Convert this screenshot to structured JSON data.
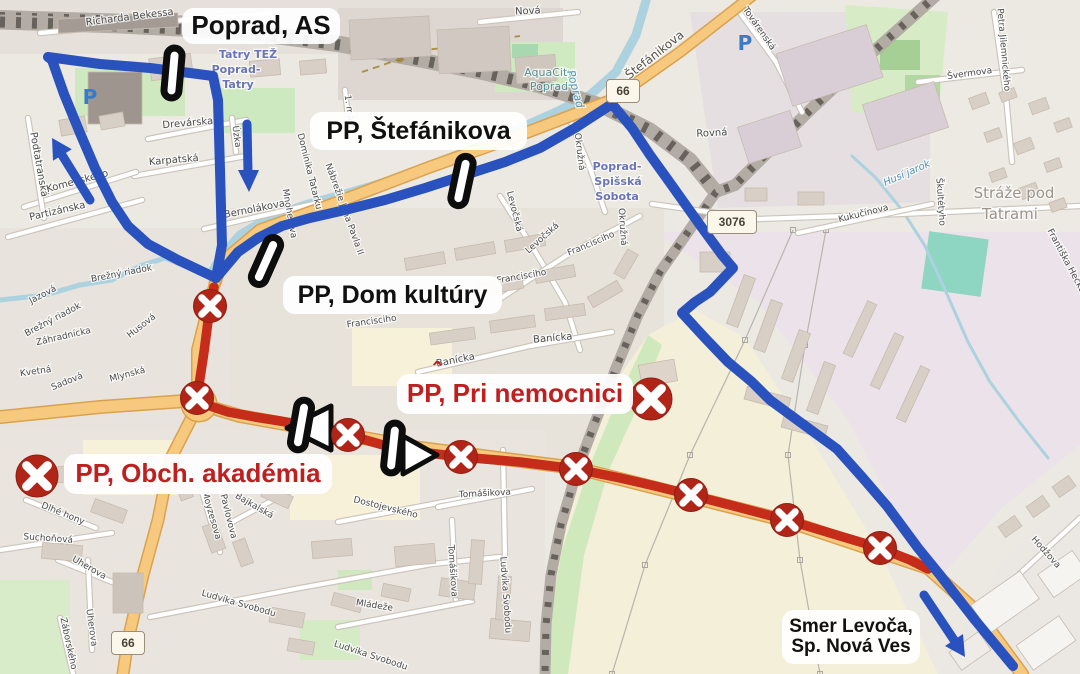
{
  "title": "Poprad bus detour map",
  "colors": {
    "route_blue": "#2a52be",
    "route_red": "#c52c19",
    "closed_x_fill": "#b02518",
    "label_text_red": "#c01f1f",
    "label_text_black": "#111111",
    "label_bg": "#ffffff",
    "stop_marker_fill": "#ffffff",
    "stop_marker_border": "#0d0d0d",
    "water": "#abd2de",
    "orange_road": "#f6c97e",
    "orange_casing": "#daa24f",
    "railway_base": "#b3aca4",
    "railway_dash": "#67625c",
    "road_white": "#ffffff",
    "road_casing": "#cbc4bb",
    "building": "#d8cfc6",
    "building_edge": "#c6bbb0",
    "farmland": "#f3efd8",
    "green_area": "#cfe8c0",
    "pitch_teal": "#8fd6c2",
    "parking_blue": "#3a7bc8"
  },
  "stop_labels": [
    {
      "id": "poprad-as",
      "text": "Poprad, AS",
      "text_color": "black"
    },
    {
      "id": "pp-stefanikova",
      "text": "PP, Štefánikova",
      "text_color": "black"
    },
    {
      "id": "pp-dom-kultury",
      "text": "PP, Dom kultúry",
      "text_color": "black"
    },
    {
      "id": "pp-pri-nemocnici",
      "text": "PP, Pri nemocnici",
      "text_color": "red",
      "accent_mark": "ˆ"
    },
    {
      "id": "pp-obch-akademia",
      "text": "PP, Obch. akadémia",
      "text_color": "red"
    },
    {
      "id": "smer-levoca",
      "line1": "Smer Levoča,",
      "line2": "Sp. Nová Ves",
      "text_color": "black"
    }
  ],
  "road_badges": [
    {
      "text": "66",
      "x": 606,
      "y": 79
    },
    {
      "text": "3076",
      "x": 707,
      "y": 210
    },
    {
      "text": "66",
      "x": 111,
      "y": 631
    }
  ],
  "parking_icons": [
    {
      "glyph": "P",
      "x": 90,
      "y": 104
    },
    {
      "glyph": "P",
      "x": 745,
      "y": 50
    }
  ],
  "routes": {
    "detour_loop_path": [
      [
        48,
        57
      ],
      [
        100,
        64
      ],
      [
        150,
        68
      ],
      [
        190,
        73
      ],
      [
        213,
        76
      ],
      [
        218,
        100
      ],
      [
        220,
        170
      ],
      [
        222,
        245
      ],
      [
        216,
        278
      ],
      [
        178,
        260
      ],
      [
        148,
        244
      ],
      [
        128,
        226
      ],
      [
        112,
        202
      ],
      [
        95,
        168
      ],
      [
        80,
        133
      ],
      [
        64,
        94
      ],
      [
        52,
        60
      ],
      [
        48,
        57
      ]
    ],
    "detour_east_path": [
      [
        216,
        278
      ],
      [
        238,
        252
      ],
      [
        258,
        238
      ],
      [
        282,
        226
      ],
      [
        310,
        218
      ],
      [
        345,
        210
      ],
      [
        385,
        200
      ],
      [
        425,
        188
      ],
      [
        462,
        176
      ],
      [
        505,
        162
      ],
      [
        540,
        148
      ],
      [
        575,
        128
      ],
      [
        612,
        104
      ],
      [
        632,
        128
      ],
      [
        650,
        155
      ],
      [
        668,
        180
      ],
      [
        700,
        225
      ],
      [
        722,
        255
      ],
      [
        733,
        268
      ],
      [
        710,
        292
      ],
      [
        695,
        302
      ],
      [
        682,
        313
      ],
      [
        705,
        338
      ],
      [
        728,
        362
      ],
      [
        752,
        382
      ],
      [
        770,
        400
      ],
      [
        800,
        422
      ],
      [
        837,
        449
      ],
      [
        862,
        477
      ],
      [
        887,
        506
      ],
      [
        918,
        548
      ],
      [
        940,
        575
      ],
      [
        975,
        620
      ],
      [
        1013,
        666
      ]
    ],
    "closed_path": [
      [
        214,
        287
      ],
      [
        210,
        306
      ],
      [
        204,
        352
      ],
      [
        197,
        398
      ],
      [
        210,
        406
      ],
      [
        228,
        412
      ],
      [
        255,
        417
      ],
      [
        280,
        421
      ],
      [
        315,
        427
      ],
      [
        348,
        435
      ],
      [
        390,
        447
      ],
      [
        420,
        452
      ],
      [
        461,
        457
      ],
      [
        520,
        462
      ],
      [
        576,
        469
      ],
      [
        620,
        478
      ],
      [
        655,
        486
      ],
      [
        691,
        495
      ],
      [
        730,
        505
      ],
      [
        787,
        520
      ],
      [
        830,
        533
      ],
      [
        880,
        548
      ],
      [
        910,
        560
      ],
      [
        928,
        569
      ]
    ]
  },
  "markers": {
    "bus_stops": [
      {
        "x": 173,
        "y": 73,
        "rot": 5
      },
      {
        "x": 462,
        "y": 181,
        "rot": 12
      },
      {
        "x": 266,
        "y": 261,
        "rot": 24
      },
      {
        "x": 301,
        "y": 425,
        "rot": 10
      },
      {
        "x": 393,
        "y": 448,
        "rot": 6
      }
    ],
    "closed_route_xs": [
      {
        "x": 210,
        "y": 306
      },
      {
        "x": 197,
        "y": 398
      },
      {
        "x": 348,
        "y": 435
      },
      {
        "x": 461,
        "y": 457
      },
      {
        "x": 576,
        "y": 469
      },
      {
        "x": 691,
        "y": 495
      },
      {
        "x": 787,
        "y": 520
      },
      {
        "x": 880,
        "y": 548
      }
    ],
    "cancelled_stop_xs": [
      {
        "x": 651,
        "y": 399
      },
      {
        "x": 37,
        "y": 476
      }
    ],
    "direction_triangles": [
      {
        "dir": "left",
        "points": [
          [
            287,
            428
          ],
          [
            331,
            406
          ],
          [
            331,
            450
          ]
        ]
      },
      {
        "dir": "right",
        "points": [
          [
            437,
            455
          ],
          [
            403,
            436
          ],
          [
            403,
            474
          ]
        ]
      }
    ],
    "direction_arrows": [
      {
        "dir": "northwest",
        "shaft": [
          [
            90,
            200
          ],
          [
            62,
            155
          ]
        ],
        "head": [
          [
            52,
            138
          ],
          [
            71.8,
            149.3
          ],
          [
            53,
            160.7
          ]
        ]
      },
      {
        "dir": "south",
        "shaft": [
          [
            247,
            124
          ],
          [
            248,
            172
          ]
        ],
        "head": [
          [
            249,
            192
          ],
          [
            238,
            170
          ],
          [
            259,
            170
          ]
        ]
      },
      {
        "dir": "southeast",
        "shaft": [
          [
            924,
            595
          ],
          [
            954,
            640
          ]
        ],
        "head": [
          [
            965,
            657
          ],
          [
            963,
            634
          ],
          [
            945,
            646
          ]
        ]
      }
    ]
  },
  "street_labels": [
    {
      "text": "Richarda Bekessa",
      "x": 130,
      "y": 20,
      "rot": -7,
      "size": 10,
      "kind": "street"
    },
    {
      "text": "Tatry TEŽ",
      "x": 248,
      "y": 58,
      "rot": 0,
      "size": 11,
      "kind": "station"
    },
    {
      "text": "Poprad-",
      "x": 236,
      "y": 73,
      "rot": 0,
      "size": 11,
      "kind": "station"
    },
    {
      "text": "Tatry",
      "x": 238,
      "y": 88,
      "rot": 0,
      "size": 11,
      "kind": "station"
    },
    {
      "text": "Drevárska",
      "x": 188,
      "y": 126,
      "rot": -5,
      "size": 10,
      "kind": "street"
    },
    {
      "text": "Karpatská",
      "x": 174,
      "y": 163,
      "rot": -5,
      "size": 10,
      "kind": "street"
    },
    {
      "text": "Podtatranská",
      "x": 36,
      "y": 165,
      "rot": 80,
      "size": 10,
      "kind": "street"
    },
    {
      "text": "Komenského",
      "x": 78,
      "y": 184,
      "rot": -15,
      "size": 10,
      "kind": "street"
    },
    {
      "text": "Partizánska",
      "x": 58,
      "y": 214,
      "rot": -13,
      "size": 10,
      "kind": "street"
    },
    {
      "text": "Bernolákova",
      "x": 255,
      "y": 212,
      "rot": -11,
      "size": 10,
      "kind": "street"
    },
    {
      "text": "Úzka",
      "x": 234,
      "y": 137,
      "rot": 82,
      "size": 9,
      "kind": "street"
    },
    {
      "text": "Mnoheľova",
      "x": 287,
      "y": 214,
      "rot": 80,
      "size": 9,
      "kind": "street"
    },
    {
      "text": "Dominika Tatarku",
      "x": 307,
      "y": 172,
      "rot": 76,
      "size": 9,
      "kind": "street"
    },
    {
      "text": "Nábrežie Jána Pavla II",
      "x": 342,
      "y": 210,
      "rot": 70,
      "size": 9,
      "kind": "street"
    },
    {
      "text": "1. mája",
      "x": 347,
      "y": 112,
      "rot": 82,
      "size": 9,
      "kind": "street"
    },
    {
      "text": "Nová",
      "x": 528,
      "y": 14,
      "rot": -3,
      "size": 10,
      "kind": "street"
    },
    {
      "text": "AquaCity",
      "x": 549,
      "y": 76,
      "rot": 0,
      "size": 11,
      "kind": "aqua"
    },
    {
      "text": "Poprad",
      "x": 549,
      "y": 90,
      "rot": 0,
      "size": 11,
      "kind": "aqua"
    },
    {
      "text": "Štefánikova",
      "x": 657,
      "y": 58,
      "rot": -38,
      "size": 12,
      "kind": "road"
    },
    {
      "text": "Poprad",
      "x": 572,
      "y": 90,
      "rot": 75,
      "size": 11,
      "kind": "water"
    },
    {
      "text": "Okružná",
      "x": 577,
      "y": 152,
      "rot": 83,
      "size": 9,
      "kind": "street"
    },
    {
      "text": "Okružná",
      "x": 620,
      "y": 227,
      "rot": 86,
      "size": 9,
      "kind": "street"
    },
    {
      "text": "Levočská",
      "x": 512,
      "y": 212,
      "rot": 76,
      "size": 9,
      "kind": "street"
    },
    {
      "text": "Levočská",
      "x": 544,
      "y": 240,
      "rot": -42,
      "size": 9,
      "kind": "street"
    },
    {
      "text": "Francisciho",
      "x": 592,
      "y": 246,
      "rot": -23,
      "size": 9,
      "kind": "street"
    },
    {
      "text": "Francisciho",
      "x": 522,
      "y": 279,
      "rot": -10,
      "size": 9,
      "kind": "street"
    },
    {
      "text": "Francisciho",
      "x": 372,
      "y": 324,
      "rot": -8,
      "size": 9,
      "kind": "street"
    },
    {
      "text": "Banícka",
      "x": 553,
      "y": 341,
      "rot": -5,
      "size": 10,
      "kind": "street"
    },
    {
      "text": "Banícka",
      "x": 456,
      "y": 363,
      "rot": -11,
      "size": 10,
      "kind": "street"
    },
    {
      "text": "Rovná",
      "x": 712,
      "y": 136,
      "rot": -3,
      "size": 10,
      "kind": "street"
    },
    {
      "text": "Poprad-",
      "x": 617,
      "y": 170,
      "rot": 0,
      "size": 11,
      "kind": "station"
    },
    {
      "text": "Spišská",
      "x": 618,
      "y": 185,
      "rot": 0,
      "size": 11,
      "kind": "station"
    },
    {
      "text": "Sobota",
      "x": 617,
      "y": 200,
      "rot": 0,
      "size": 11,
      "kind": "station"
    },
    {
      "text": "Brežný riadok",
      "x": 122,
      "y": 276,
      "rot": -11,
      "size": 9,
      "kind": "street"
    },
    {
      "text": "Brežný riadok",
      "x": 54,
      "y": 322,
      "rot": -28,
      "size": 9,
      "kind": "street"
    },
    {
      "text": "Jazová",
      "x": 44,
      "y": 297,
      "rot": -28,
      "size": 9,
      "kind": "street"
    },
    {
      "text": "Záhradnícka",
      "x": 64,
      "y": 339,
      "rot": -13,
      "size": 9,
      "kind": "street"
    },
    {
      "text": "Husová",
      "x": 143,
      "y": 328,
      "rot": -38,
      "size": 9,
      "kind": "street"
    },
    {
      "text": "Kvetná",
      "x": 36,
      "y": 374,
      "rot": -8,
      "size": 9,
      "kind": "street"
    },
    {
      "text": "Sadová",
      "x": 68,
      "y": 384,
      "rot": -22,
      "size": 9,
      "kind": "street"
    },
    {
      "text": "Mlynská",
      "x": 128,
      "y": 377,
      "rot": -15,
      "size": 9,
      "kind": "street"
    },
    {
      "text": "Továrenská",
      "x": 757,
      "y": 30,
      "rot": 55,
      "size": 9,
      "kind": "street"
    },
    {
      "text": "Švermova",
      "x": 970,
      "y": 76,
      "rot": -8,
      "size": 9,
      "kind": "street"
    },
    {
      "text": "Petra Jilemnického",
      "x": 1001,
      "y": 50,
      "rot": 85,
      "size": 9,
      "kind": "street"
    },
    {
      "text": "Kukučínova",
      "x": 864,
      "y": 216,
      "rot": -14,
      "size": 9,
      "kind": "street"
    },
    {
      "text": "Škultétyho",
      "x": 938,
      "y": 202,
      "rot": 86,
      "size": 9,
      "kind": "street"
    },
    {
      "text": "Husí jarok",
      "x": 908,
      "y": 176,
      "rot": -24,
      "size": 10,
      "kind": "water"
    },
    {
      "text": "Stráže pod",
      "x": 1014,
      "y": 198,
      "rot": 0,
      "size": 15,
      "kind": "place"
    },
    {
      "text": "Tatrami",
      "x": 1010,
      "y": 219,
      "rot": 0,
      "size": 15,
      "kind": "place"
    },
    {
      "text": "Františka Hečku",
      "x": 1064,
      "y": 262,
      "rot": 62,
      "size": 9,
      "kind": "street"
    },
    {
      "text": "Hodžova",
      "x": 1044,
      "y": 554,
      "rot": 48,
      "size": 9,
      "kind": "street"
    },
    {
      "text": "Dlhé hony",
      "x": 62,
      "y": 516,
      "rot": 22,
      "size": 9,
      "kind": "street"
    },
    {
      "text": "Suchoňová",
      "x": 48,
      "y": 541,
      "rot": 4,
      "size": 9,
      "kind": "street"
    },
    {
      "text": "Uherova",
      "x": 88,
      "y": 570,
      "rot": 30,
      "size": 9,
      "kind": "street"
    },
    {
      "text": "Uherova",
      "x": 89,
      "y": 628,
      "rot": 82,
      "size": 9,
      "kind": "street"
    },
    {
      "text": "Záborského",
      "x": 66,
      "y": 644,
      "rot": 78,
      "size": 9,
      "kind": "street"
    },
    {
      "text": "Moyzesova",
      "x": 209,
      "y": 516,
      "rot": 74,
      "size": 9,
      "kind": "street"
    },
    {
      "text": "Pavlovova",
      "x": 226,
      "y": 517,
      "rot": 76,
      "size": 9,
      "kind": "street"
    },
    {
      "text": "Bajkalská",
      "x": 253,
      "y": 508,
      "rot": 30,
      "size": 9,
      "kind": "street"
    },
    {
      "text": "Ludvíka Svobodu",
      "x": 238,
      "y": 606,
      "rot": 16,
      "size": 9,
      "kind": "street"
    },
    {
      "text": "Ludvíka Svobodu",
      "x": 370,
      "y": 658,
      "rot": 18,
      "size": 9,
      "kind": "street"
    },
    {
      "text": "Ludvíka Svobodu",
      "x": 503,
      "y": 595,
      "rot": 86,
      "size": 9,
      "kind": "street"
    },
    {
      "text": "Dostojevského",
      "x": 385,
      "y": 510,
      "rot": 14,
      "size": 9,
      "kind": "street"
    },
    {
      "text": "Tomášikova",
      "x": 485,
      "y": 496,
      "rot": -3,
      "size": 9,
      "kind": "street"
    },
    {
      "text": "Tomášikova",
      "x": 450,
      "y": 571,
      "rot": 86,
      "size": 9,
      "kind": "street"
    },
    {
      "text": "Mládeže",
      "x": 374,
      "y": 608,
      "rot": 9,
      "size": 9,
      "kind": "street"
    }
  ]
}
